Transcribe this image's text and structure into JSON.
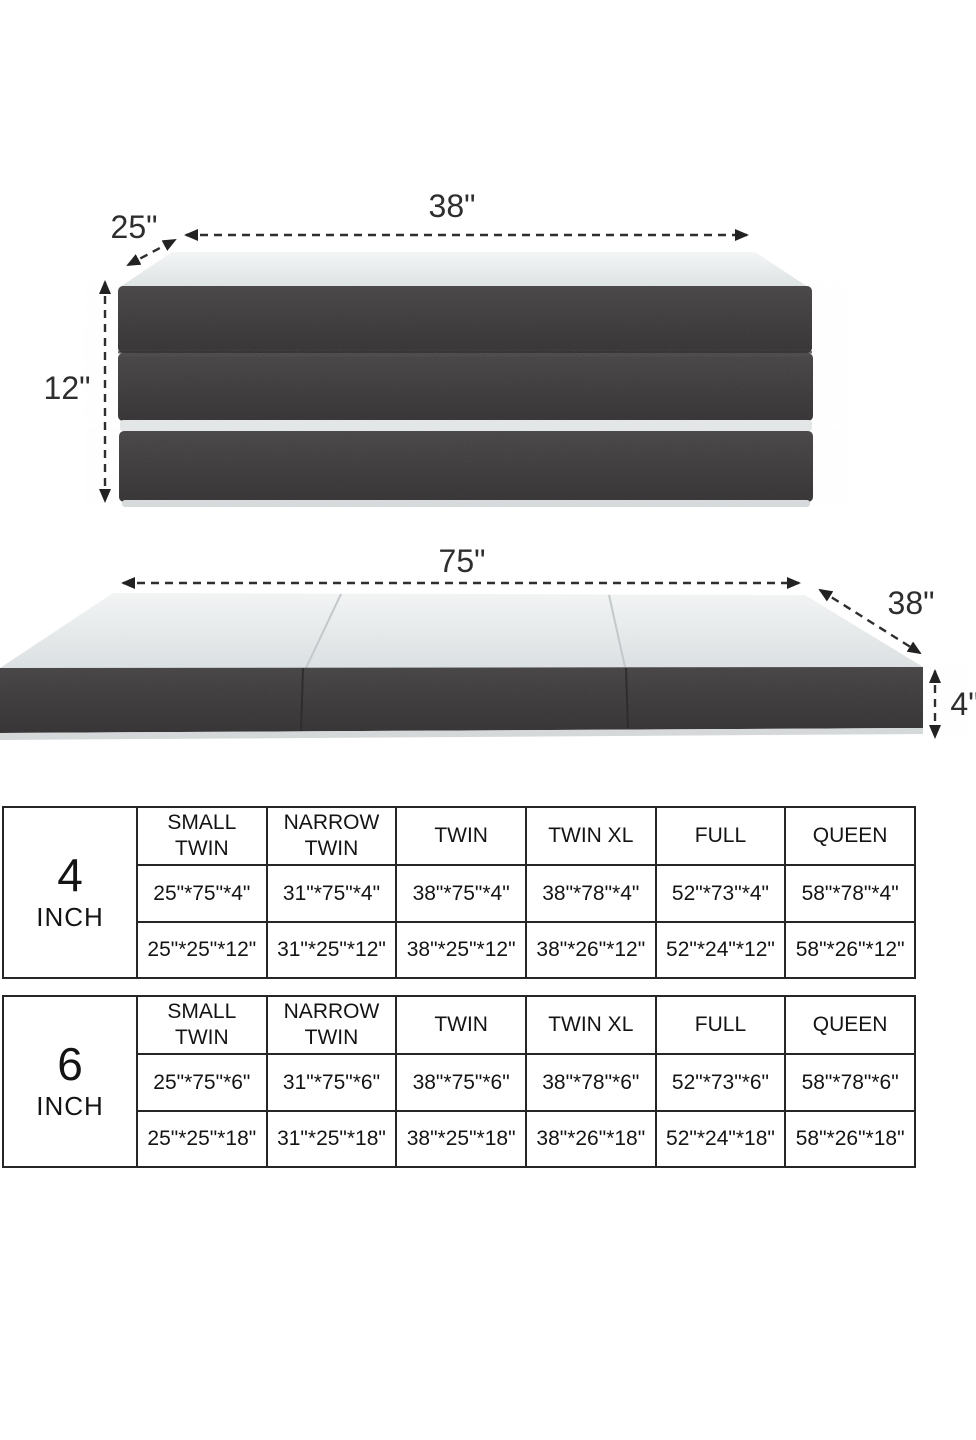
{
  "folded_diagram": {
    "width": "38\"",
    "depth": "25\"",
    "height": "12\""
  },
  "unfolded_diagram": {
    "length": "75\"",
    "width": "38\"",
    "height": "4\""
  },
  "tables": [
    {
      "label_value": "4",
      "label_unit": "INCH",
      "headers": [
        "SMALL TWIN",
        "NARROW TWIN",
        "TWIN",
        "TWIN XL",
        "FULL",
        "QUEEN"
      ],
      "unfolded": [
        "25\"*75\"*4\"",
        "31\"*75\"*4\"",
        "38\"*75\"*4\"",
        "38\"*78\"*4\"",
        "52\"*73\"*4\"",
        "58\"*78\"*4\""
      ],
      "folded": [
        "25\"*25\"*12\"",
        "31\"*25\"*12\"",
        "38\"*25\"*12\"",
        "38\"*26\"*12\"",
        "52\"*24\"*12\"",
        "58\"*26\"*12\""
      ]
    },
    {
      "label_value": "6",
      "label_unit": "INCH",
      "headers": [
        "SMALL TWIN",
        "NARROW TWIN",
        "TWIN",
        "TWIN XL",
        "FULL",
        "QUEEN"
      ],
      "unfolded": [
        "25\"*75\"*6\"",
        "31\"*75\"*6\"",
        "38\"*75\"*6\"",
        "38\"*78\"*6\"",
        "52\"*73\"*6\"",
        "58\"*78\"*6\""
      ],
      "folded": [
        "25\"*25\"*18\"",
        "31\"*25\"*18\"",
        "38\"*25\"*18\"",
        "38\"*26\"*18\"",
        "52\"*24\"*18\"",
        "58\"*26\"*18\""
      ]
    }
  ],
  "colors": {
    "fabric_dark": "#3b3839",
    "mattress_top": "#eef1f1",
    "dimension_text": "#2e2e2e",
    "table_border": "#262626"
  }
}
